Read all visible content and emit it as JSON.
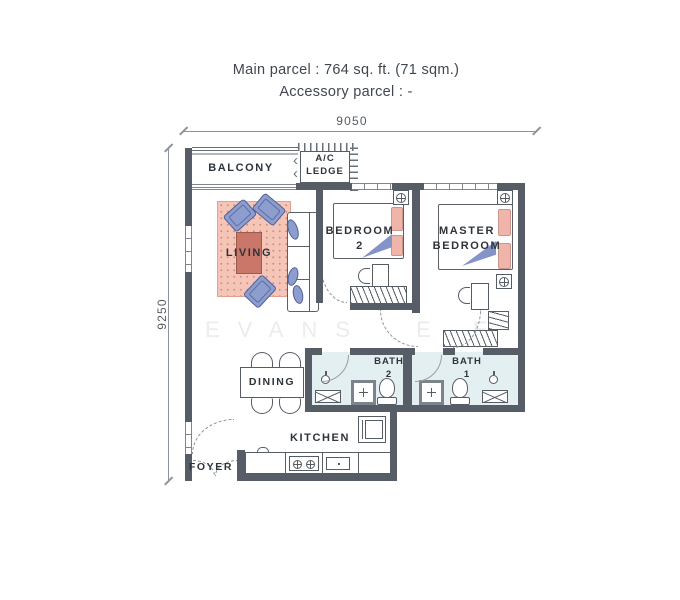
{
  "title": {
    "line1": "Main parcel : 764 sq. ft. (71 sqm.)",
    "line2": "Accessory parcel : -"
  },
  "dimensions": {
    "width": "9050",
    "height": "9250"
  },
  "watermark": "EVANS  E E",
  "icons": {
    "chevron": "‹"
  },
  "rooms": {
    "balcony": "BALCONY",
    "ac_ledge": [
      "A/C",
      "LEDGE"
    ],
    "living": "LIVING",
    "bedroom2": [
      "BEDROOM",
      "2"
    ],
    "master": [
      "MASTER",
      "BEDROOM"
    ],
    "dining": "DINING",
    "bath2": [
      "BATH",
      "2"
    ],
    "bath1": [
      "BATH",
      "1"
    ],
    "kitchen": "KITCHEN",
    "foyer": "FOYER"
  },
  "colors": {
    "wall": "#575d66",
    "bath_floor": "#e3eff0",
    "rug": "#f5c5b8",
    "rug_dot": "#cf8b7b",
    "furniture_blue": "#8d9dce",
    "furniture_blue_border": "#515f97",
    "pillow_pink": "#f0b5aa",
    "coffee_table_red": "#ca7668",
    "line_gray": "#6a7077",
    "watermark_gray": "#ececec"
  }
}
